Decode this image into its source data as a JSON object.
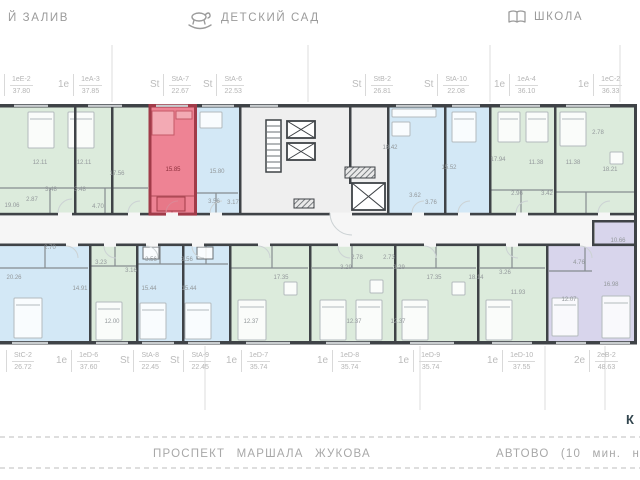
{
  "landmarks": {
    "left": "Й ЗАЛИВ",
    "kindergarten": "ДЕТСКИЙ САД",
    "school": "ШКОЛА"
  },
  "units": {
    "top": [
      {
        "prefix": "",
        "code": "1еЕ-2",
        "area": "37.80"
      },
      {
        "prefix": "1е",
        "code": "1еА-3",
        "area": "37.85"
      },
      {
        "prefix": "St",
        "code": "StA-7",
        "area": "22.67",
        "highlighted": true
      },
      {
        "prefix": "St",
        "code": "StA-6",
        "area": "22.53"
      },
      {
        "prefix": "St",
        "code": "StB-2",
        "area": "26.81"
      },
      {
        "prefix": "St",
        "code": "StA-10",
        "area": "22.08"
      },
      {
        "prefix": "1е",
        "code": "1еА-4",
        "area": "36.10"
      },
      {
        "prefix": "1е",
        "code": "1еС-2",
        "area": "36.33"
      }
    ],
    "bottom": [
      {
        "prefix": "",
        "code": "StC-2",
        "area": "26.72"
      },
      {
        "prefix": "1е",
        "code": "1еD-6",
        "area": "37.60"
      },
      {
        "prefix": "St",
        "code": "StA-8",
        "area": "22.45"
      },
      {
        "prefix": "St",
        "code": "StA-9",
        "area": "22.45"
      },
      {
        "prefix": "1е",
        "code": "1еD-7",
        "area": "35.74"
      },
      {
        "prefix": "1е",
        "code": "1еD-8",
        "area": "35.74"
      },
      {
        "prefix": "1е",
        "code": "1еD-9",
        "area": "35.74"
      },
      {
        "prefix": "1е",
        "code": "1еD-10",
        "area": "37.55"
      },
      {
        "prefix": "2е",
        "code": "2еВ-2",
        "area": "48.63"
      }
    ]
  },
  "rooms": [
    "12.11",
    "12.11",
    "19.06",
    "17.56",
    "3.48",
    "3.48",
    "2.87",
    "4.70",
    "15.85",
    "15.80",
    "3.56",
    "3.17",
    "18.42",
    "15.52",
    "3.62",
    "3.76",
    "17.94",
    "11.38",
    "11.38",
    "2.96",
    "3.42",
    "18.21",
    "2.78",
    "20.26",
    "2.70",
    "3.23",
    "3.16",
    "14.91",
    "12.00",
    "15.44",
    "15.44",
    "3.56",
    "3.56",
    "12.37",
    "17.35",
    "2.78",
    "2.73",
    "3.29",
    "3.29",
    "17.35",
    "18.14",
    "3.26",
    "11.93",
    "12.37",
    "12.37",
    "10.66",
    "4.76",
    "16.98",
    "12.07"
  ],
  "road": {
    "street": "ПРОСПЕКТ МАРШАЛА ЖУКОВА",
    "metro": "АВТОВО (10 мин. на трансп",
    "corner_mark": "К"
  },
  "colors": {
    "unit_green": "#dcebdc",
    "unit_blue": "#d3e8f6",
    "unit_purple": "#d8d5ec",
    "unit_highlight_red": "#ee8394",
    "highlight_wall_red": "#a13b49",
    "wall_dark": "#3f4347",
    "corridor": "#f6f6f6",
    "label_gray": "#b5b5b5",
    "landmark_gray": "#9b9b9b",
    "road_gray": "#a8a8a8"
  }
}
